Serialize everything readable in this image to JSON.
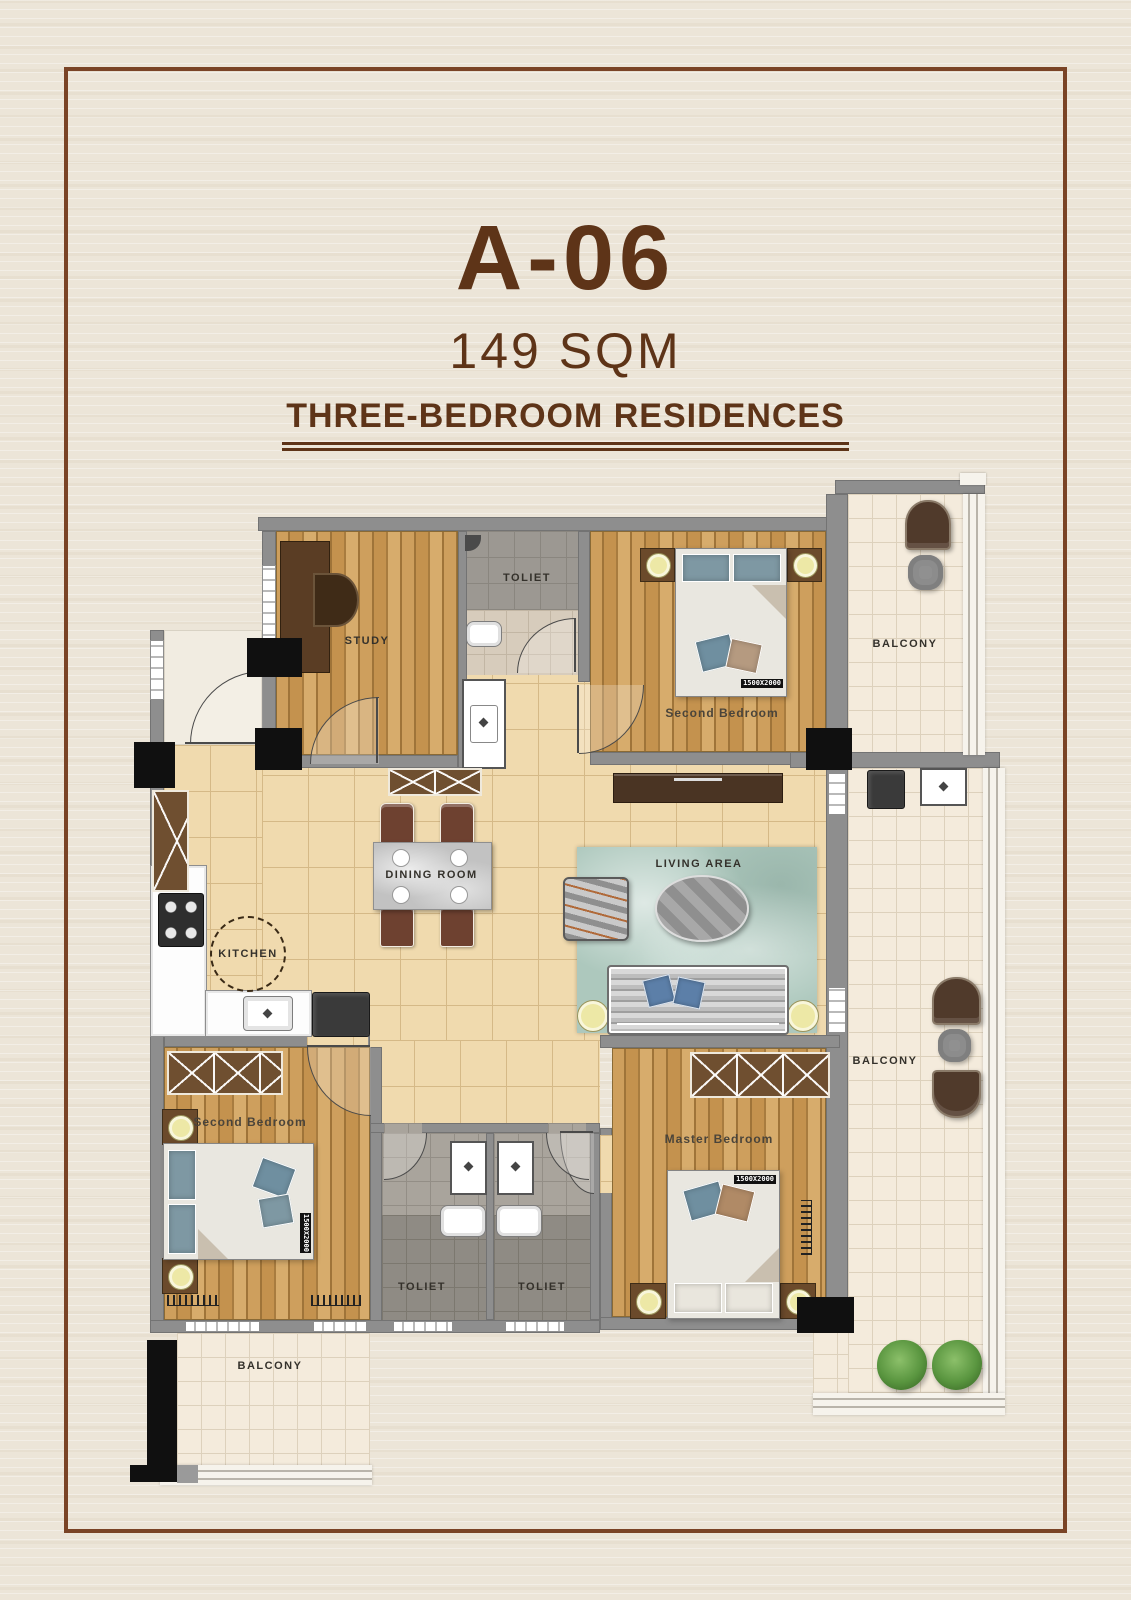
{
  "header": {
    "unit": "A-06",
    "area": "149 SQM",
    "type": "THREE-BEDROOM RESIDENCES"
  },
  "rooms": {
    "study": {
      "label": "STUDY"
    },
    "toilet_top": {
      "label": "TOLIET"
    },
    "bedroom_top": {
      "label": "Second Bedroom",
      "bed_tag": "1500X2000"
    },
    "balcony_top": {
      "label": "BALCONY"
    },
    "dining": {
      "label": "DINING  ROOM"
    },
    "living": {
      "label": "LIVING   AREA"
    },
    "kitchen": {
      "label": "KITCHEN"
    },
    "bedroom_left": {
      "label": "Second Bedroom",
      "bed_tag": "1500X2000"
    },
    "toilet_left": {
      "label": "TOLIET"
    },
    "toilet_right": {
      "label": "TOLIET"
    },
    "master": {
      "label": "Master Bedroom",
      "bed_tag": "1500X2000"
    },
    "balcony_right": {
      "label": "BALCONY"
    },
    "balcony_bottom": {
      "label": "BALCONY"
    }
  },
  "colors": {
    "accent": "#5E3418",
    "frame": "#7A4426",
    "bg": "#ECE5D8",
    "wall": "#8E8E8E",
    "tan": "#F0DAAE",
    "tanline": "#D5B987",
    "cream": "#F4EBDC",
    "creamline": "#DDD1BC",
    "rug": "#ADC8BD"
  }
}
